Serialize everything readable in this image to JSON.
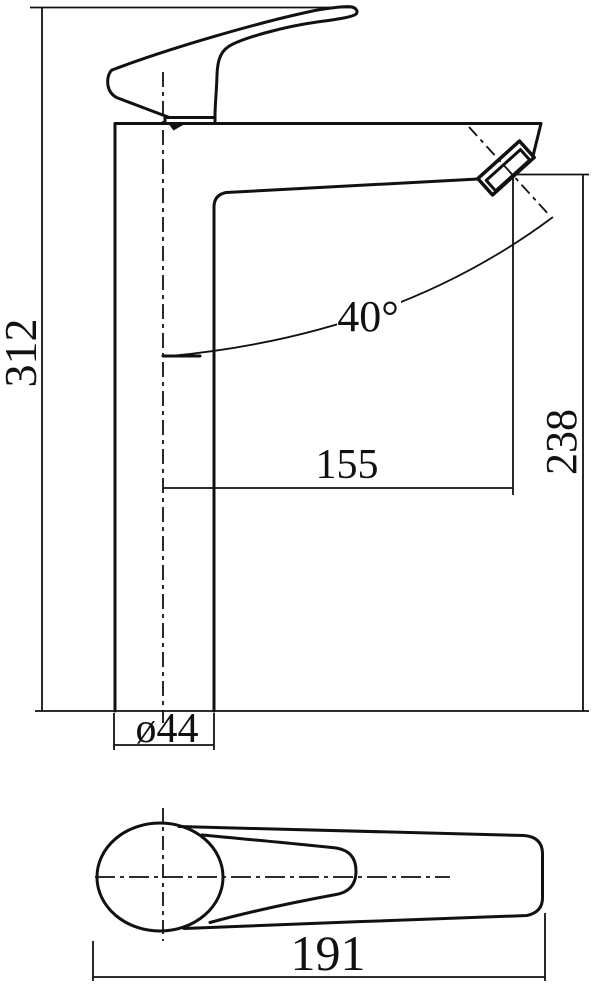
{
  "drawing": {
    "kind": "faucet-technical-drawing",
    "colors": {
      "line": "#111111",
      "background": "#ffffff"
    },
    "labels": {
      "total_height": "312",
      "spout_reach": "155",
      "spout_outlet_height": "238",
      "spout_angle": "40°",
      "base_diameter": "ø44",
      "handle_length": "191"
    }
  }
}
